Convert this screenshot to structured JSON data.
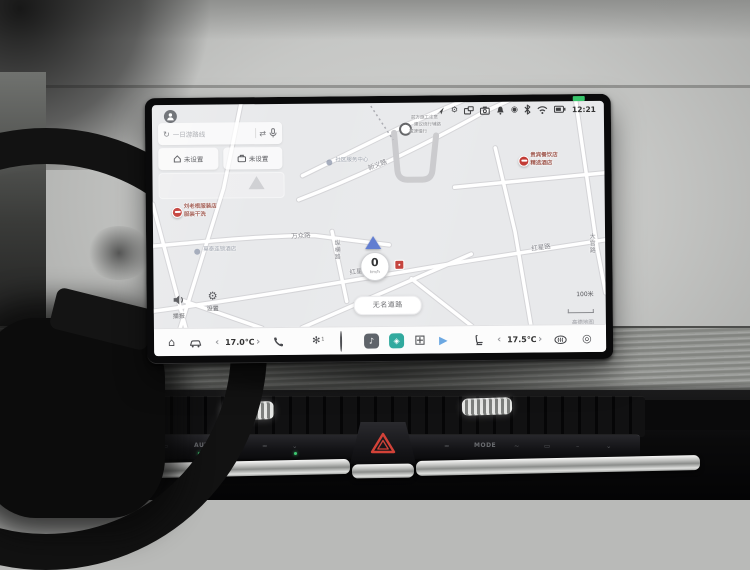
{
  "status": {
    "time": "12:21",
    "icons": [
      "nav-arrow",
      "gear",
      "screen-cast",
      "camera",
      "bell",
      "record",
      "bluetooth",
      "wifi",
      "battery"
    ],
    "gear_glyph": "⚙",
    "record_glyph": "◉"
  },
  "nav_panel": {
    "search": {
      "refresh_glyph": "↻",
      "placeholder": "一日游路线",
      "route_glyph": "⇄"
    },
    "shortcuts": [
      {
        "label": "未设置"
      },
      {
        "label": "未设置"
      }
    ]
  },
  "map": {
    "labels": [
      {
        "text": "新义路"
      },
      {
        "text": "万众路"
      },
      {
        "text": "纵横路"
      },
      {
        "text": "红星路"
      },
      {
        "text": "红星路"
      },
      {
        "text": "大官路"
      }
    ],
    "pois": [
      {
        "lines": [
          "刘老根服装店",
          "服装干洗"
        ]
      },
      {
        "lines": [
          "贵宾餐饮店",
          "精选酒店"
        ]
      },
      {
        "lines": [
          "前方施工注意",
          "建议绕行辅路",
          "减速慢行"
        ]
      },
      {
        "lines": [
          "社区服务中心"
        ]
      },
      {
        "lines": [
          "莫泰连锁酒店"
        ]
      }
    ],
    "speed": {
      "value": "0",
      "unit": "km/h"
    },
    "road_pill": "无名道路",
    "tools": [
      {
        "label": "播报"
      },
      {
        "label": "设置",
        "glyph": "⚙"
      }
    ],
    "scale": {
      "distance": "100米",
      "provider": "高德地图"
    }
  },
  "dock": {
    "items": [
      {
        "name": "home",
        "glyph": "⌂"
      },
      {
        "name": "climate-car"
      },
      {
        "name": "chevron-left",
        "glyph": "‹"
      },
      {
        "name": "driver-temp",
        "text": "17.0℃"
      },
      {
        "name": "chevron-right",
        "glyph": "›"
      },
      {
        "name": "phone"
      },
      {
        "name": "fan",
        "glyph": "✻",
        "badge": "1"
      },
      {
        "name": "connect"
      },
      {
        "name": "app-music",
        "glyph": "♪"
      },
      {
        "name": "app-assistant",
        "glyph": "◈"
      },
      {
        "name": "app-grid",
        "glyph": "⊞"
      },
      {
        "name": "app-media",
        "glyph": "▶"
      },
      {
        "name": "seat"
      },
      {
        "name": "chevron-left",
        "glyph": "‹"
      },
      {
        "name": "passenger-temp",
        "text": "17.5℃"
      },
      {
        "name": "chevron-right",
        "glyph": "›"
      },
      {
        "name": "defrost"
      },
      {
        "name": "volume-knob",
        "glyph": "◎"
      }
    ]
  },
  "console": {
    "start_button": {
      "line1": "START",
      "line2": "STOP"
    },
    "left_strip_label": "AUTO",
    "right_strip_label": "MODE"
  }
}
